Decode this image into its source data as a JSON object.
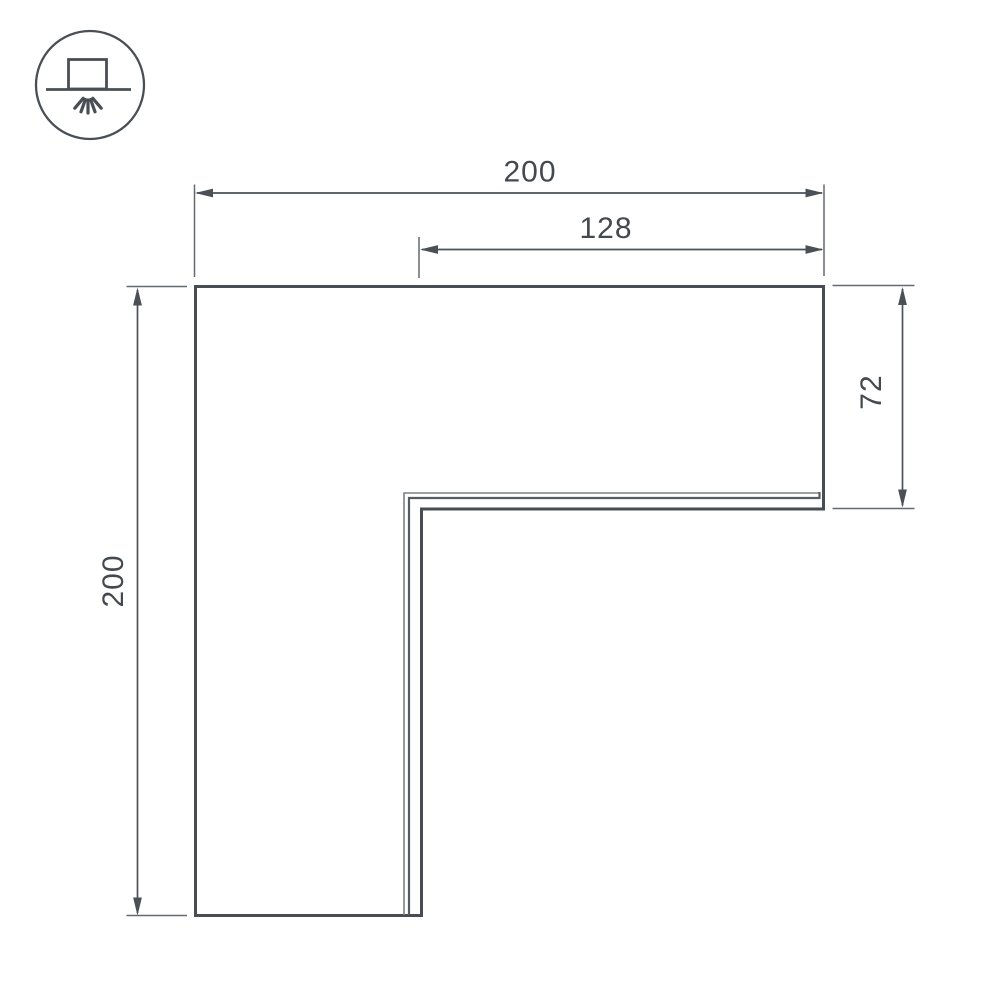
{
  "colors": {
    "background": "#ffffff",
    "line": "#474d53",
    "detail": "#565c62",
    "detail_light": "#7a8086",
    "dim": "#4a5056",
    "ext": "#626970",
    "text": "#43494e",
    "icon": "#4a4f55"
  },
  "icons": {
    "mount_type": "surface-mount-downlight-icon"
  },
  "drawing": {
    "type": "technical-dimension-drawing",
    "shape": "L-shaped corner profile",
    "dimensions": {
      "overall_width": "200",
      "inner_width": "128",
      "overall_height": "200",
      "leg_depth": "72"
    }
  }
}
